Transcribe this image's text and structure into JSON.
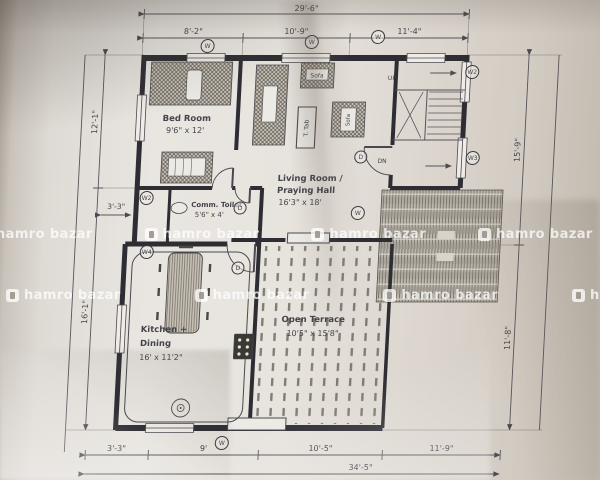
{
  "watermark": {
    "brand": "hamro bazar"
  },
  "plan": {
    "dims": {
      "top_total": "29'-6\"",
      "top_seg1": "8'-2\"",
      "top_seg2": "10'-9\"",
      "top_seg3": "11'-4\"",
      "bottom_seg1": "3'-3\"",
      "bottom_seg2": "9'",
      "bottom_seg3": "10'-5\"",
      "bottom_seg4": "11'-9\"",
      "bottom_total": "34'-5\"",
      "left_top": "12'-1\"",
      "left_bottom": "16'-1\"",
      "left_small": "3'-3\"",
      "right_top": "15'-9\"",
      "right_bottom": "11'-8\""
    },
    "rooms": {
      "bedroom_name": "Bed Room",
      "bedroom_size": "9'6\" x 12'",
      "living_name1": "Living Room /",
      "living_name2": "Praying Hall",
      "living_size": "16'3\" x 18'",
      "toilet_name": "Comm. Toilet",
      "toilet_size": "5'6\" x 4'",
      "kitchen_name1": "Kitchen +",
      "kitchen_name2": "Dining",
      "kitchen_size": "16' x 11'2\"",
      "terrace_name": "Open Terrace",
      "terrace_size": "10'5\" x 15'8\""
    },
    "furniture": {
      "sofa_top": "Sofa",
      "sofa_right": "Sofa",
      "tea_table": "T. Tab"
    },
    "stairs": {
      "up": "UP",
      "dn": "DN"
    },
    "markers": [
      {
        "label": "W"
      },
      {
        "label": "W"
      },
      {
        "label": "W"
      },
      {
        "label": "W2"
      },
      {
        "label": "W3"
      },
      {
        "label": "W2"
      },
      {
        "label": "W4"
      },
      {
        "label": "D"
      },
      {
        "label": "D"
      },
      {
        "label": "D"
      },
      {
        "label": "W"
      },
      {
        "label": "W"
      }
    ]
  }
}
